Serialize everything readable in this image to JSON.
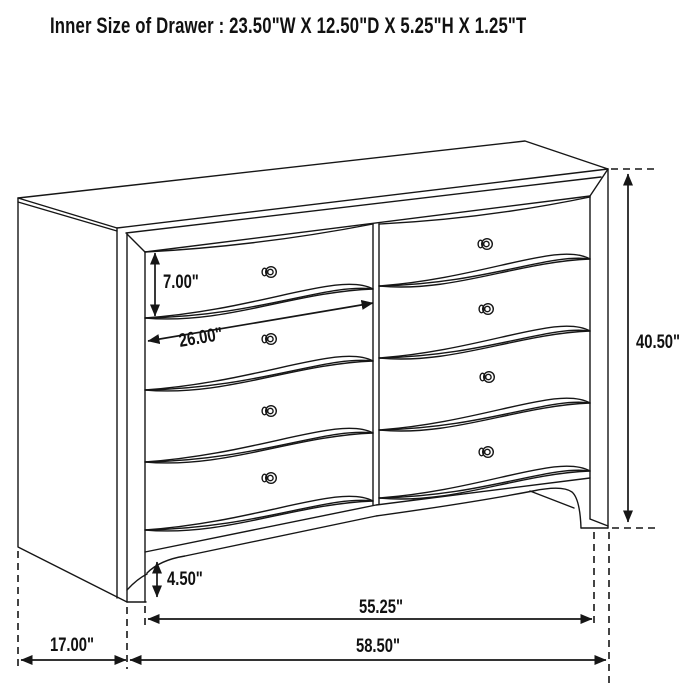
{
  "title": "Inner Size of Drawer : 23.50\"W X 12.50\"D X 5.25\"H X 1.25\"T",
  "dimensions": {
    "drawer_front_height": "7.00\"",
    "drawer_front_width": "26.00\"",
    "overall_height": "40.50\"",
    "base_height": "4.50\"",
    "feet_span_width": "55.25\"",
    "overall_width": "58.50\"",
    "side_depth": "17.00\""
  },
  "colors": {
    "line": "#161616",
    "background": "#ffffff"
  }
}
